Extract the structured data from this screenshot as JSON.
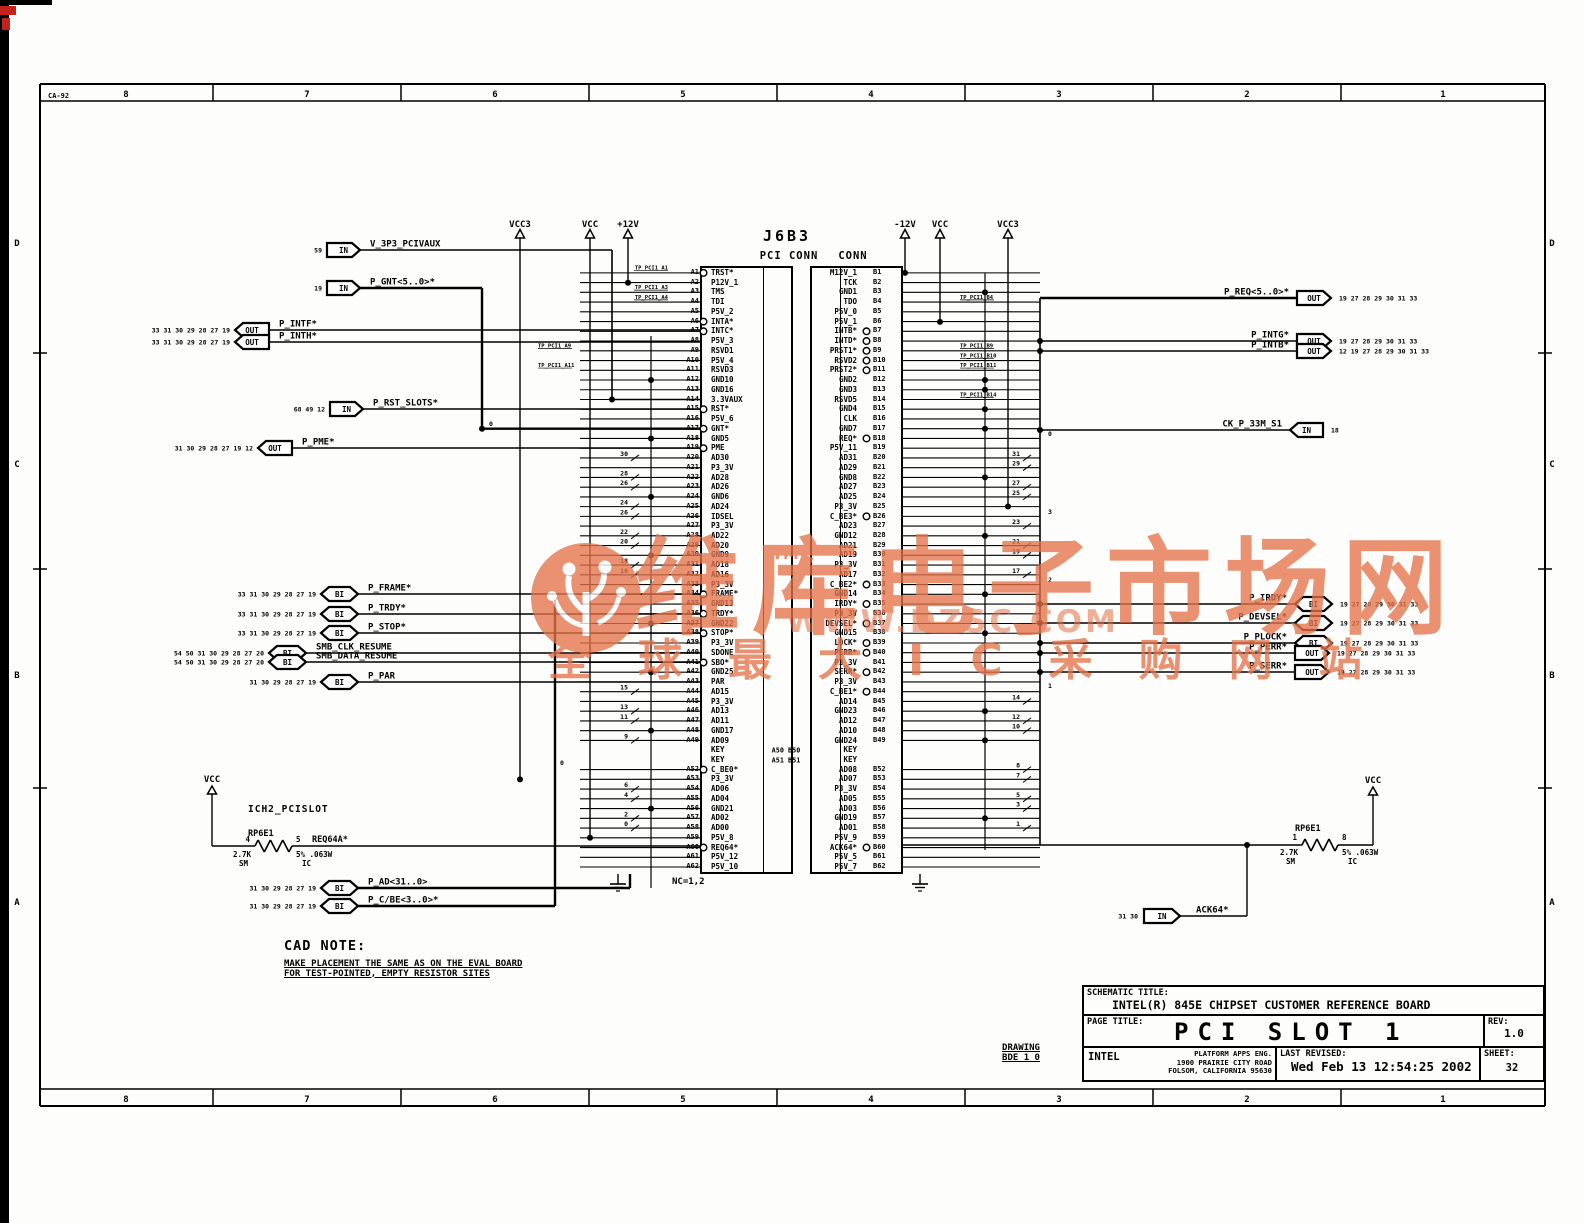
{
  "sheet": {
    "doc_code": "CA-92",
    "zones_h": [
      "8",
      "7",
      "6",
      "5",
      "4",
      "3",
      "2",
      "1"
    ],
    "zones_v": [
      "D",
      "C",
      "B",
      "A"
    ]
  },
  "connector": {
    "refdes": "J6B3",
    "label_left": "PCI CONN",
    "label_right": "CONN",
    "nc_note": "NC=1,2",
    "key_gap_labels": [
      "A50 B50",
      "A51 B51"
    ],
    "pins_a": [
      {
        "p": "A1",
        "n": "TRST*",
        "b": 1,
        "tp": "TP_PCI1_A1"
      },
      {
        "p": "A2",
        "n": "P12V_1"
      },
      {
        "p": "A3",
        "n": "TMS",
        "tp": "TP_PCI1_A3"
      },
      {
        "p": "A4",
        "n": "TDI",
        "tp": "TP_PCI1_A4"
      },
      {
        "p": "A5",
        "n": "P5V_2"
      },
      {
        "p": "A6",
        "n": "INTA*",
        "b": 1
      },
      {
        "p": "A7",
        "n": "INTC*",
        "b": 1
      },
      {
        "p": "A8",
        "n": "P5V_3"
      },
      {
        "p": "A9",
        "n": "RSVD1",
        "tp": "TP_PCI1_A9"
      },
      {
        "p": "A10",
        "n": "P5V_4"
      },
      {
        "p": "A11",
        "n": "RSVD3",
        "tp": "TP_PCI1_A11"
      },
      {
        "p": "A12",
        "n": "GND10"
      },
      {
        "p": "A13",
        "n": "GND16"
      },
      {
        "p": "A14",
        "n": "3.3VAUX"
      },
      {
        "p": "A15",
        "n": "RST*",
        "b": 1
      },
      {
        "p": "A16",
        "n": "P5V_6"
      },
      {
        "p": "A17",
        "n": "GNT*",
        "b": 1
      },
      {
        "p": "A18",
        "n": "GND5"
      },
      {
        "p": "A19",
        "n": "PME",
        "b": 1
      },
      {
        "p": "A20",
        "n": "AD30",
        "t": "30"
      },
      {
        "p": "A21",
        "n": "P3_3V"
      },
      {
        "p": "A22",
        "n": "AD28",
        "t": "28"
      },
      {
        "p": "A23",
        "n": "AD26",
        "t": "26"
      },
      {
        "p": "A24",
        "n": "GND6"
      },
      {
        "p": "A25",
        "n": "AD24",
        "t": "24"
      },
      {
        "p": "A26",
        "n": "IDSEL",
        "t": "26"
      },
      {
        "p": "A27",
        "n": "P3_3V"
      },
      {
        "p": "A28",
        "n": "AD22",
        "t": "22"
      },
      {
        "p": "A29",
        "n": "AD20",
        "t": "20"
      },
      {
        "p": "A30",
        "n": "GND9"
      },
      {
        "p": "A31",
        "n": "AD18",
        "t": "18"
      },
      {
        "p": "A32",
        "n": "AD16",
        "t": "16"
      },
      {
        "p": "A33",
        "n": "P3_3V"
      },
      {
        "p": "A34",
        "n": "FRAME*",
        "b": 1
      },
      {
        "p": "A35",
        "n": "GND13"
      },
      {
        "p": "A36",
        "n": "TRDY*",
        "b": 1
      },
      {
        "p": "A37",
        "n": "GND22"
      },
      {
        "p": "A38",
        "n": "STOP*",
        "b": 1
      },
      {
        "p": "A39",
        "n": "P3_3V"
      },
      {
        "p": "A40",
        "n": "SDONE"
      },
      {
        "p": "A41",
        "n": "SBO*",
        "b": 1
      },
      {
        "p": "A42",
        "n": "GND25"
      },
      {
        "p": "A43",
        "n": "PAR"
      },
      {
        "p": "A44",
        "n": "AD15",
        "t": "15"
      },
      {
        "p": "A45",
        "n": "P3_3V"
      },
      {
        "p": "A46",
        "n": "AD13",
        "t": "13"
      },
      {
        "p": "A47",
        "n": "AD11",
        "t": "11"
      },
      {
        "p": "A48",
        "n": "GND17"
      },
      {
        "p": "A49",
        "n": "AD09",
        "t": "9"
      },
      {
        "p": "A50",
        "n": "KEY",
        "k": 1
      },
      {
        "p": "A51",
        "n": "KEY",
        "k": 1
      },
      {
        "p": "A52",
        "n": "C_BE0*",
        "b": 1
      },
      {
        "p": "A53",
        "n": "P3_3V"
      },
      {
        "p": "A54",
        "n": "AD06",
        "t": "6"
      },
      {
        "p": "A55",
        "n": "AD04",
        "t": "4"
      },
      {
        "p": "A56",
        "n": "GND21"
      },
      {
        "p": "A57",
        "n": "AD02",
        "t": "2"
      },
      {
        "p": "A58",
        "n": "AD00",
        "t": "0"
      },
      {
        "p": "A59",
        "n": "P5V_8"
      },
      {
        "p": "A60",
        "n": "REQ64*",
        "b": 1
      },
      {
        "p": "A61",
        "n": "P5V_12"
      },
      {
        "p": "A62",
        "n": "P5V_10"
      }
    ],
    "pins_b": [
      {
        "p": "B1",
        "n": "M12V_1"
      },
      {
        "p": "B2",
        "n": "TCK"
      },
      {
        "p": "B3",
        "n": "GND1"
      },
      {
        "p": "B4",
        "n": "TDO",
        "tp": "TP_PCI1_B4"
      },
      {
        "p": "B5",
        "n": "P5V_0"
      },
      {
        "p": "B6",
        "n": "P5V_1"
      },
      {
        "p": "B7",
        "n": "INTB*",
        "b": 1
      },
      {
        "p": "B8",
        "n": "INTD*",
        "b": 1
      },
      {
        "p": "B9",
        "n": "PRST1*",
        "b": 1,
        "tp": "TP_PCI1_B9"
      },
      {
        "p": "B10",
        "n": "RSVD2",
        "b": 1,
        "tp": "TP_PCI1_B10"
      },
      {
        "p": "B11",
        "n": "PRST2*",
        "b": 1,
        "tp": "TP_PCI1_B11"
      },
      {
        "p": "B12",
        "n": "GND2"
      },
      {
        "p": "B13",
        "n": "GND3"
      },
      {
        "p": "B14",
        "n": "RSVD5",
        "tp": "TP_PCI1_B14"
      },
      {
        "p": "B15",
        "n": "GND4"
      },
      {
        "p": "B16",
        "n": "CLK"
      },
      {
        "p": "B17",
        "n": "GND7"
      },
      {
        "p": "B18",
        "n": "REQ*",
        "b": 1
      },
      {
        "p": "B19",
        "n": "P5V_11"
      },
      {
        "p": "B20",
        "n": "AD31",
        "t": "31"
      },
      {
        "p": "B21",
        "n": "AD29",
        "t": "29"
      },
      {
        "p": "B22",
        "n": "GND8"
      },
      {
        "p": "B23",
        "n": "AD27",
        "t": "27"
      },
      {
        "p": "B24",
        "n": "AD25",
        "t": "25"
      },
      {
        "p": "B25",
        "n": "P3_3V"
      },
      {
        "p": "B26",
        "n": "C_BE3*",
        "b": 1
      },
      {
        "p": "B27",
        "n": "AD23",
        "t": "23"
      },
      {
        "p": "B28",
        "n": "GND12"
      },
      {
        "p": "B29",
        "n": "AD21",
        "t": "21"
      },
      {
        "p": "B30",
        "n": "AD19",
        "t": "19"
      },
      {
        "p": "B31",
        "n": "P3_3V"
      },
      {
        "p": "B32",
        "n": "AD17",
        "t": "17"
      },
      {
        "p": "B33",
        "n": "C_BE2*",
        "b": 1
      },
      {
        "p": "B34",
        "n": "GND14"
      },
      {
        "p": "B35",
        "n": "IRDY*",
        "b": 1
      },
      {
        "p": "B36",
        "n": "P3_3V"
      },
      {
        "p": "B37",
        "n": "DEVSEL*",
        "b": 1
      },
      {
        "p": "B38",
        "n": "GND15"
      },
      {
        "p": "B39",
        "n": "LOCK*",
        "b": 1
      },
      {
        "p": "B40",
        "n": "PERR*",
        "b": 1
      },
      {
        "p": "B41",
        "n": "P3_3V"
      },
      {
        "p": "B42",
        "n": "SERR*",
        "b": 1
      },
      {
        "p": "B43",
        "n": "P3_3V"
      },
      {
        "p": "B44",
        "n": "C_BE1*",
        "b": 1
      },
      {
        "p": "B45",
        "n": "AD14",
        "t": "14"
      },
      {
        "p": "B46",
        "n": "GND23"
      },
      {
        "p": "B47",
        "n": "AD12",
        "t": "12"
      },
      {
        "p": "B48",
        "n": "AD10",
        "t": "10"
      },
      {
        "p": "B49",
        "n": "GND24"
      },
      {
        "p": "B50",
        "n": "KEY",
        "k": 1
      },
      {
        "p": "B51",
        "n": "KEY",
        "k": 1
      },
      {
        "p": "B52",
        "n": "AD08",
        "t": "8"
      },
      {
        "p": "B53",
        "n": "AD07",
        "t": "7"
      },
      {
        "p": "B54",
        "n": "P3_3V"
      },
      {
        "p": "B55",
        "n": "AD05",
        "t": "5"
      },
      {
        "p": "B56",
        "n": "AD03",
        "t": "3"
      },
      {
        "p": "B57",
        "n": "GND19"
      },
      {
        "p": "B58",
        "n": "AD01",
        "t": "1"
      },
      {
        "p": "B59",
        "n": "P5V_9"
      },
      {
        "p": "B60",
        "n": "ACK64*",
        "b": 1
      },
      {
        "p": "B61",
        "n": "P5V_5"
      },
      {
        "p": "B62",
        "n": "P5V_7"
      }
    ]
  },
  "power_rails": [
    {
      "label": "VCC3"
    },
    {
      "label": "VCC"
    },
    {
      "label": "+12V"
    },
    {
      "label": "-12V"
    },
    {
      "label": "VCC"
    },
    {
      "label": "VCC3"
    }
  ],
  "left_ports": [
    {
      "refs": "59",
      "dir": "IN",
      "name": "V_3P3_PCIVAUX"
    },
    {
      "refs": "19",
      "dir": "IN",
      "name": "P_GNT<5..0>*"
    },
    {
      "refs": "33 31 30 29 28 27 19",
      "dir": "OUT",
      "name": "P_INTF*"
    },
    {
      "refs": "33 31 30 29 28 27 19",
      "dir": "OUT",
      "name": "P_INTH*"
    },
    {
      "refs": "68 49 12",
      "dir": "IN",
      "name": "P_RST_SLOTS*"
    },
    {
      "refs": "31 30 29 28 27 19 12",
      "dir": "OUT",
      "name": "P_PME*"
    },
    {
      "refs": "33 31 30 29 28 27 19",
      "dir": "BI",
      "name": "P_FRAME*"
    },
    {
      "refs": "33 31 30 29 28 27 19",
      "dir": "BI",
      "name": "P_TRDY*"
    },
    {
      "refs": "33 31 30 29 28 27 19",
      "dir": "BI",
      "name": "P_STOP*"
    },
    {
      "refs": "54 50 31 30 29 28 27 20",
      "dir": "BI",
      "name": "SMB_CLK_RESUME"
    },
    {
      "refs": "54 50 31 30 29 28 27 20",
      "dir": "BI",
      "name": "SMB_DATA_RESUME"
    },
    {
      "refs": "31 30 29 28 27 19",
      "dir": "BI",
      "name": "P_PAR"
    },
    {
      "refs": "31 30 29 28 27 19",
      "dir": "BI",
      "name": "P_AD<31..0>"
    },
    {
      "refs": "31 30 29 28 27 19",
      "dir": "BI",
      "name": "P_C/BE<3..0>*"
    }
  ],
  "right_ports": [
    {
      "refs": "19 27 28 29 30 31 33",
      "dir": "OUT",
      "name": "P_REQ<5..0>*"
    },
    {
      "refs": "19 27 28 29 30 31 33",
      "dir": "OUT",
      "name": "P_INTG*"
    },
    {
      "refs": "12 19 27 28 29 30 31 33",
      "dir": "OUT",
      "name": "P_INTB*"
    },
    {
      "refs": "18",
      "dir": "IN",
      "name": "CK_P_33M_S1"
    },
    {
      "refs": "19 27 28 29 30 31 33",
      "dir": "BI",
      "name": "P_IRDY*"
    },
    {
      "refs": "19 27 28 29 30 31 33",
      "dir": "BI",
      "name": "P_DEVSEL*"
    },
    {
      "refs": "19 27 28 29 30 31 33",
      "dir": "BI",
      "name": "P_PLOCK*"
    },
    {
      "refs": "19 27 28 29 30 31 33",
      "dir": "OUT",
      "name": "P_PERR*"
    },
    {
      "refs": "19 27 28 29 30 31 33",
      "dir": "OUT",
      "name": "P_SERR*"
    },
    {
      "refs": "31 30",
      "dir": "IN",
      "name": "ACK64*"
    }
  ],
  "bus_bit_labels": [
    {
      "t": "0"
    },
    {
      "t": "0"
    },
    {
      "t": "0"
    },
    {
      "t": "3"
    },
    {
      "t": "2"
    },
    {
      "t": "1"
    }
  ],
  "resistors": {
    "left": {
      "group": "ICH2_PCISLOT",
      "refdes": "RP6E1",
      "pins": [
        "4",
        "5"
      ],
      "value": "2.7K",
      "pkg": "SM",
      "rating": "5% .063W",
      "cls": "IC",
      "net": "REQ64A*",
      "rail": "VCC"
    },
    "right": {
      "refdes": "RP6E1",
      "pins": [
        "1",
        "8"
      ],
      "value": "2.7K",
      "pkg": "SM",
      "rating": "5% .063W",
      "cls": "IC",
      "rail": "VCC"
    }
  },
  "cad_note": {
    "title": "CAD NOTE:",
    "line1": "MAKE PLACEMENT THE SAME AS ON THE EVAL BOARD",
    "line2": "FOR TEST-POINTED, EMPTY RESISTOR SITES"
  },
  "drawing": {
    "label": "DRAWING",
    "number": "BDE_1_0"
  },
  "title_block": {
    "schematic_title_label": "SCHEMATIC TITLE:",
    "schematic_title": "INTEL(R) 845E CHIPSET CUSTOMER REFERENCE BOARD",
    "page_title_label": "PAGE TITLE:",
    "page_title": "PCI SLOT 1",
    "rev_label": "REV:",
    "rev": "1.0",
    "company": "INTEL",
    "dept": "PLATFORM APPS ENG.",
    "address1": "1900 PRAIRIE CITY ROAD",
    "address2": "FOLSOM, CALIFORNIA 95630",
    "last_revised_label": "LAST REVISED:",
    "last_revised": "Wed Feb 13 12:54:25 2002",
    "sheet_label": "SHEET:",
    "sheet_number": "32"
  },
  "watermark": {
    "brand": "维库电子市场网",
    "tm": "TM",
    "url": "WWW.DZSC.COM",
    "tagline": "全球最大IC采购网站",
    "color": "#e4734a"
  },
  "colors": {
    "line": "#000000",
    "accent": "#e4734a",
    "red_mark": "#c3231a"
  }
}
